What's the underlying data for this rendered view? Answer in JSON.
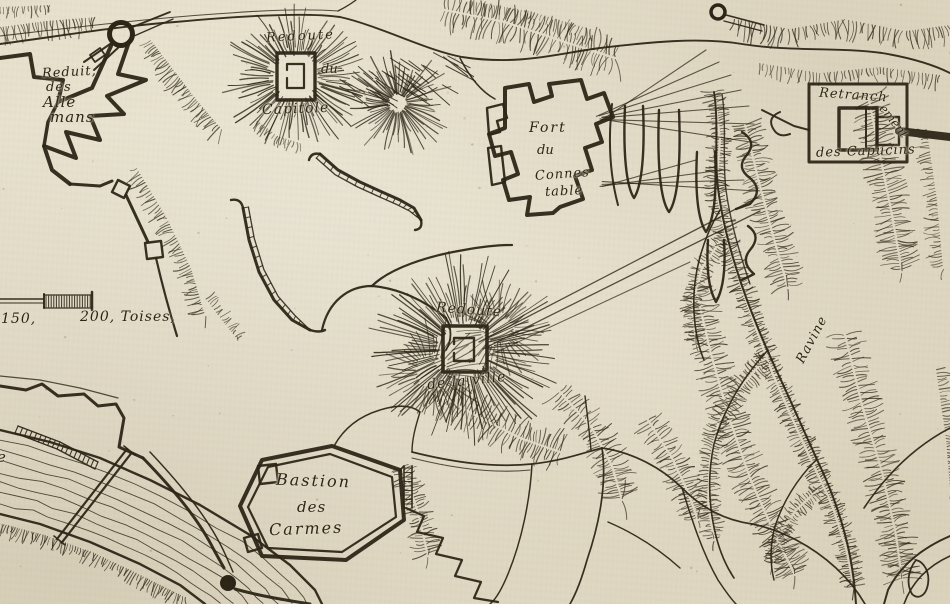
{
  "meta": {
    "kind": "antique engraved fortification map",
    "style": "17th-century French siege plan, ink engraving on paper"
  },
  "palette": {
    "paper": "#e5dec9",
    "ink": "#2c2517",
    "speckle": "#6b5530"
  },
  "labels": {
    "reduit_des_allemans": {
      "l1": "Reduit,",
      "l2": "des",
      "l3": "Alle",
      "l4": "mans"
    },
    "redoute_du_capitole": {
      "l1": "Redoute",
      "l2": "du",
      "l3": "Capitole"
    },
    "fort_du_connestable": {
      "l1": "Fort",
      "l2": "du",
      "l3": "Connes",
      "l4": "table"
    },
    "retranchement_des_capucins": {
      "l1": "Retranch",
      "l1b": "ement",
      "l2": "des Capucins"
    },
    "redoute_de_la_ville": {
      "l1": "Redoute",
      "l2": "de la ville"
    },
    "bastion_des_carmes": {
      "l1": "Bastion",
      "l2": "des",
      "l3": "Carmes"
    },
    "ravine": {
      "text": "Ravine"
    },
    "scale_bar": {
      "t150": "150,",
      "t200": "200, Toises,"
    },
    "edge_fragment": {
      "text": "e"
    }
  }
}
